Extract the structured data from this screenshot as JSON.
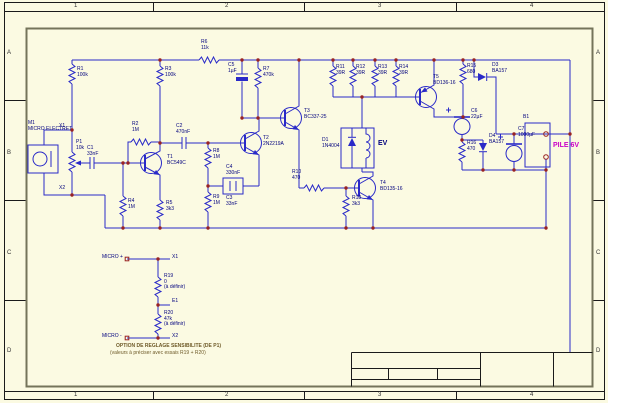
{
  "sheet": {
    "type": "circuit-schematic-sheet",
    "zone_columns": [
      "1",
      "2",
      "3",
      "4"
    ],
    "zone_rows": [
      "A",
      "B",
      "C",
      "D"
    ],
    "title_block_text": "",
    "battery_label": "PILE 6V",
    "load_label": "EV",
    "mic_label": "MICRO ELECTRET"
  },
  "colors": {
    "sheet_cream": "#fbfae2",
    "wire_blue": "#2929c8",
    "label_navy": "#00007e",
    "junction_red": "#992222",
    "battery_magenta": "#c800c8",
    "note_brown": "#6e5a28",
    "frame_black": "#1a1a1a",
    "inner_frame_olive": "#74745a"
  },
  "components": {
    "transistors": [
      "T1 BC549C",
      "T2 2N2219A",
      "T3 BC337-25",
      "T4 BD135-16",
      "T5 BD136-16"
    ],
    "resistors": [
      "R1 100k",
      "R2 1M",
      "R3 100k",
      "R4 1M",
      "R5 3k3",
      "R6 11k",
      "R7 470k",
      "R8 1M",
      "R9 1M",
      "R10 470",
      "R11 39R",
      "R12 39R",
      "R13 39R",
      "R14 39R",
      "R15 680",
      "R16 470",
      "R18 3k3",
      "R19 0 (à définir)",
      "R20 47k (à définir)"
    ],
    "capacitors": [
      "C1 33nF",
      "C2 470nF",
      "C3 33nF",
      "C4 330nF",
      "C5 1µF",
      "C6 22µF",
      "C7 1000µF"
    ],
    "diodes": [
      "D1 1N4004",
      "D3 BA157",
      "D4 BA157"
    ],
    "other": [
      "M1 MICRO ELECTRET",
      "P1 10k",
      "B1 PILE 6V",
      "EV"
    ]
  },
  "labels": [
    {
      "name": "zone-top-1",
      "x": 74,
      "y": 3,
      "s": 6,
      "c": "#333333",
      "lines": [
        "1"
      ]
    },
    {
      "name": "zone-top-2",
      "x": 225,
      "y": 3,
      "s": 6,
      "c": "#333333",
      "lines": [
        "2"
      ]
    },
    {
      "name": "zone-top-3",
      "x": 378,
      "y": 3,
      "s": 6,
      "c": "#333333",
      "lines": [
        "3"
      ]
    },
    {
      "name": "zone-top-4",
      "x": 530,
      "y": 3,
      "s": 6,
      "c": "#333333",
      "lines": [
        "4"
      ]
    },
    {
      "name": "zone-bottom-1",
      "x": 74,
      "y": 392,
      "s": 6,
      "c": "#333333",
      "lines": [
        "1"
      ]
    },
    {
      "name": "zone-bottom-2",
      "x": 225,
      "y": 392,
      "s": 6,
      "c": "#333333",
      "lines": [
        "2"
      ]
    },
    {
      "name": "zone-bottom-3",
      "x": 378,
      "y": 392,
      "s": 6,
      "c": "#333333",
      "lines": [
        "3"
      ]
    },
    {
      "name": "zone-bottom-4",
      "x": 530,
      "y": 392,
      "s": 6,
      "c": "#333333",
      "lines": [
        "4"
      ]
    },
    {
      "name": "zone-left-a",
      "x": 7,
      "y": 50,
      "s": 6,
      "c": "#333333",
      "lines": [
        "A"
      ]
    },
    {
      "name": "zone-left-b",
      "x": 7,
      "y": 150,
      "s": 6,
      "c": "#333333",
      "lines": [
        "B"
      ]
    },
    {
      "name": "zone-left-c",
      "x": 7,
      "y": 250,
      "s": 6,
      "c": "#333333",
      "lines": [
        "C"
      ]
    },
    {
      "name": "zone-left-d",
      "x": 7,
      "y": 348,
      "s": 6,
      "c": "#333333",
      "lines": [
        "D"
      ]
    },
    {
      "name": "zone-right-a",
      "x": 596,
      "y": 50,
      "s": 6,
      "c": "#333333",
      "lines": [
        "A"
      ]
    },
    {
      "name": "zone-right-b",
      "x": 596,
      "y": 150,
      "s": 6,
      "c": "#333333",
      "lines": [
        "B"
      ]
    },
    {
      "name": "zone-right-c",
      "x": 596,
      "y": 250,
      "s": 6,
      "c": "#333333",
      "lines": [
        "C"
      ]
    },
    {
      "name": "zone-right-d",
      "x": 596,
      "y": 348,
      "s": 6,
      "c": "#333333",
      "lines": [
        "D"
      ]
    },
    {
      "name": "label-m1",
      "x": 28,
      "y": 121,
      "lines": [
        "M1",
        "MICRO ELECTRET"
      ]
    },
    {
      "name": "label-x1",
      "x": 59,
      "y": 124,
      "lines": [
        "X1"
      ]
    },
    {
      "name": "label-x2",
      "x": 59,
      "y": 186,
      "lines": [
        "X2"
      ]
    },
    {
      "name": "label-r1",
      "x": 77,
      "y": 67,
      "lines": [
        "R1",
        "100k"
      ]
    },
    {
      "name": "label-p1",
      "x": 76,
      "y": 140,
      "lines": [
        "P1",
        "10k"
      ]
    },
    {
      "name": "label-c1",
      "x": 87,
      "y": 146,
      "lines": [
        "C1",
        "33nF"
      ]
    },
    {
      "name": "label-r2",
      "x": 132,
      "y": 122,
      "lines": [
        "R2",
        "1M"
      ]
    },
    {
      "name": "label-r4",
      "x": 128,
      "y": 199,
      "lines": [
        "R4",
        "1M"
      ]
    },
    {
      "name": "label-r3",
      "x": 165,
      "y": 67,
      "lines": [
        "R3",
        "100k"
      ]
    },
    {
      "name": "label-t1",
      "x": 167,
      "y": 155,
      "lines": [
        "T1",
        "BC549C"
      ]
    },
    {
      "name": "label-r5",
      "x": 166,
      "y": 201,
      "lines": [
        "R5",
        "3k3"
      ]
    },
    {
      "name": "label-c2",
      "x": 176,
      "y": 124,
      "lines": [
        "C2",
        "470nF"
      ]
    },
    {
      "name": "label-r6",
      "x": 201,
      "y": 40,
      "lines": [
        "R6",
        "11k"
      ]
    },
    {
      "name": "label-r8",
      "x": 213,
      "y": 149,
      "lines": [
        "R8",
        "1M"
      ]
    },
    {
      "name": "label-r9",
      "x": 213,
      "y": 195,
      "lines": [
        "R9",
        "1M"
      ]
    },
    {
      "name": "label-c4",
      "x": 226,
      "y": 165,
      "lines": [
        "C4",
        "330nF"
      ]
    },
    {
      "name": "label-c3",
      "x": 226,
      "y": 196,
      "lines": [
        "C3",
        "33nF"
      ]
    },
    {
      "name": "label-c5",
      "x": 228,
      "y": 63,
      "lines": [
        "C5",
        "1µF"
      ]
    },
    {
      "name": "label-r7",
      "x": 263,
      "y": 67,
      "lines": [
        "R7",
        "470k"
      ]
    },
    {
      "name": "label-t2",
      "x": 263,
      "y": 136,
      "lines": [
        "T2",
        "2N2219A"
      ]
    },
    {
      "name": "label-t3",
      "x": 304,
      "y": 109,
      "lines": [
        "T3",
        "BC337-25"
      ]
    },
    {
      "name": "label-r10",
      "x": 292,
      "y": 170,
      "lines": [
        "R10",
        "470"
      ]
    },
    {
      "name": "label-r18",
      "x": 352,
      "y": 196,
      "lines": [
        "R18",
        "3k3"
      ]
    },
    {
      "name": "label-d1",
      "x": 322,
      "y": 138,
      "lines": [
        "D1",
        "1N4004"
      ]
    },
    {
      "name": "label-ev",
      "x": 378,
      "y": 140,
      "s": 7,
      "b": 1,
      "lines": [
        "EV"
      ]
    },
    {
      "name": "label-t4",
      "x": 380,
      "y": 181,
      "lines": [
        "T4",
        "BD135-16"
      ]
    },
    {
      "name": "label-r11",
      "x": 336,
      "y": 65,
      "lines": [
        "R11",
        "39R"
      ]
    },
    {
      "name": "label-r12",
      "x": 356,
      "y": 65,
      "lines": [
        "R12",
        "39R"
      ]
    },
    {
      "name": "label-r13",
      "x": 378,
      "y": 65,
      "lines": [
        "R13",
        "39R"
      ]
    },
    {
      "name": "label-r14",
      "x": 399,
      "y": 65,
      "lines": [
        "R14",
        "39R"
      ]
    },
    {
      "name": "label-t5",
      "x": 433,
      "y": 75,
      "lines": [
        "T5",
        "BD136-16"
      ]
    },
    {
      "name": "label-r15",
      "x": 467,
      "y": 64,
      "lines": [
        "R15",
        "680"
      ]
    },
    {
      "name": "label-d3",
      "x": 492,
      "y": 63,
      "lines": [
        "D3",
        "BA157"
      ]
    },
    {
      "name": "label-c6",
      "x": 471,
      "y": 109,
      "lines": [
        "C6",
        "22µF"
      ]
    },
    {
      "name": "label-r16",
      "x": 467,
      "y": 141,
      "lines": [
        "R16",
        "470"
      ]
    },
    {
      "name": "label-d4",
      "x": 489,
      "y": 134,
      "lines": [
        "D4",
        "BA157"
      ]
    },
    {
      "name": "label-c7",
      "x": 518,
      "y": 127,
      "lines": [
        "C7",
        "1000µF"
      ]
    },
    {
      "name": "label-b1",
      "x": 523,
      "y": 115,
      "lines": [
        "B1"
      ]
    },
    {
      "name": "label-pile-6v",
      "x": 553,
      "y": 142,
      "s": 7,
      "b": 1,
      "c": "#c800c8",
      "lines": [
        "PILE 6V"
      ]
    },
    {
      "name": "label-micro-plus",
      "x": 102,
      "y": 255,
      "lines": [
        "MICRO +"
      ]
    },
    {
      "name": "label-x1-option",
      "x": 172,
      "y": 255,
      "lines": [
        "X1"
      ]
    },
    {
      "name": "label-r19",
      "x": 164,
      "y": 274,
      "lines": [
        "R19",
        "0",
        "(à définir)"
      ]
    },
    {
      "name": "label-e1-option",
      "x": 172,
      "y": 299,
      "lines": [
        "E1"
      ]
    },
    {
      "name": "label-r20",
      "x": 164,
      "y": 311,
      "lines": [
        "R20",
        "47k",
        "(à définir)"
      ]
    },
    {
      "name": "label-micro-minus",
      "x": 102,
      "y": 334,
      "lines": [
        "MICRO -"
      ]
    },
    {
      "name": "label-x2-option",
      "x": 172,
      "y": 334,
      "lines": [
        "X2"
      ]
    },
    {
      "name": "note-line-1",
      "x": 116,
      "y": 344,
      "b": 1,
      "c": "#6e5a28",
      "lines": [
        "OPTION DE REGLAGE SENSIBILITE (DE P1)"
      ]
    },
    {
      "name": "note-line-2",
      "x": 110,
      "y": 351,
      "c": "#6e5a28",
      "lines": [
        "(valeurs à préciser avec essais R19 + R20)"
      ]
    }
  ]
}
